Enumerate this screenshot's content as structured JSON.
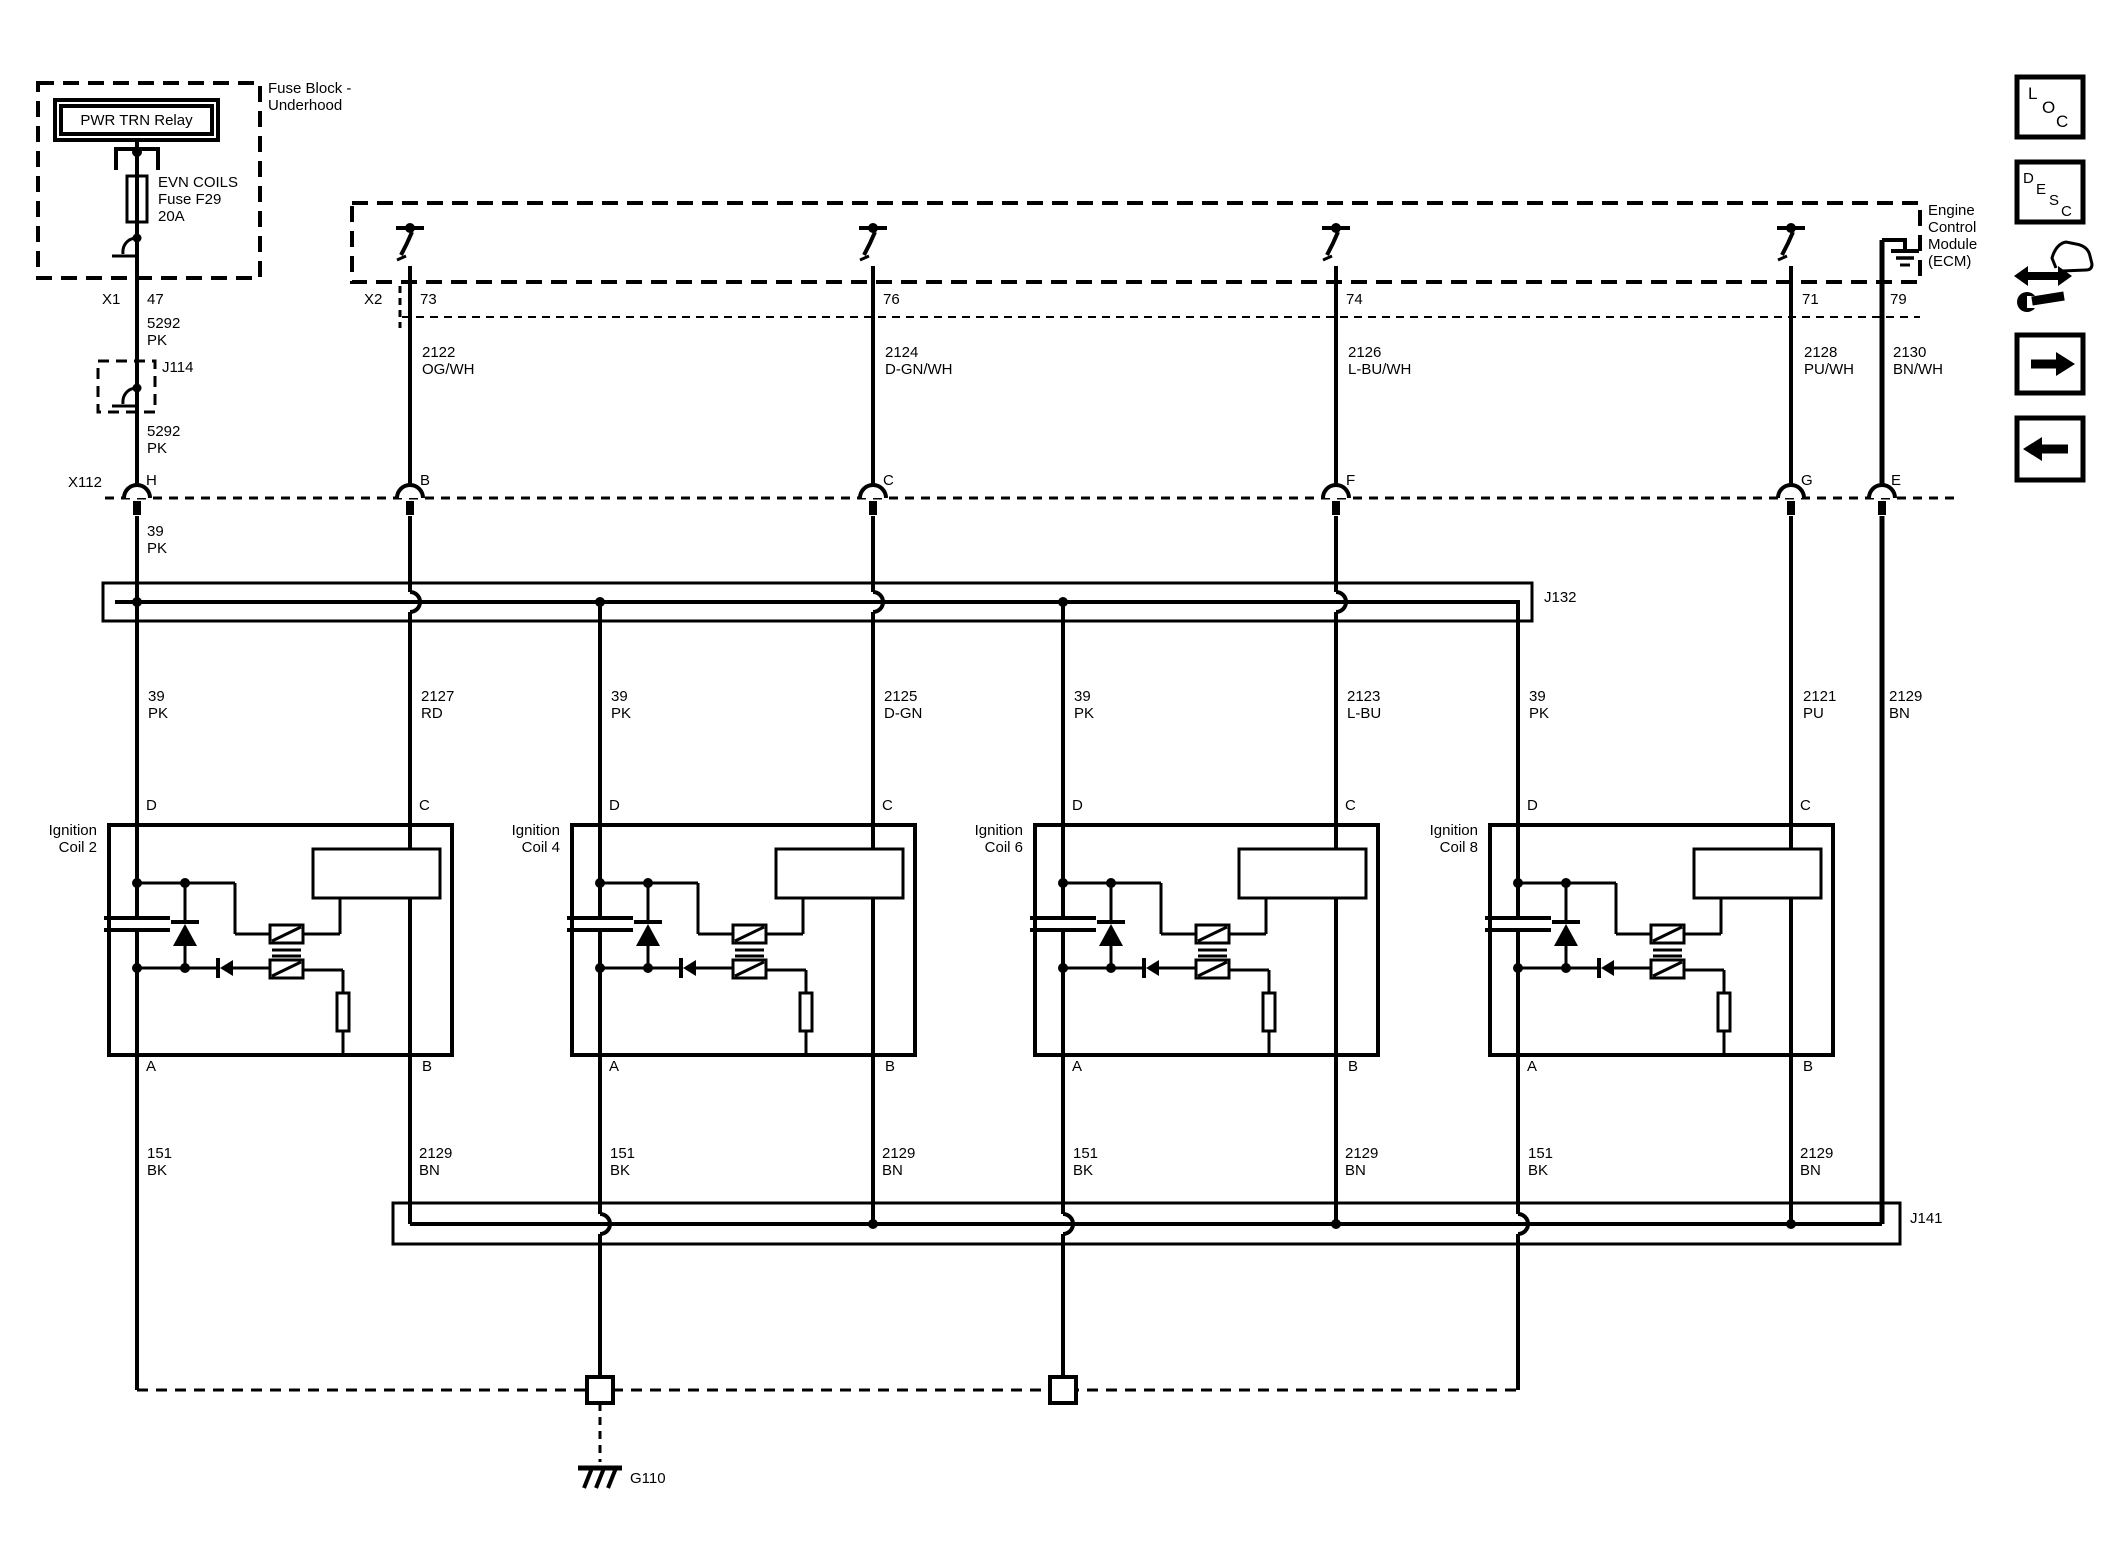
{
  "diagram": {
    "fuse_block": {
      "title1": "Fuse Block -",
      "title2": "Underhood",
      "relay_label": "PWR TRN Relay",
      "fuse_name": "EVN COILS",
      "fuse_id": "Fuse F29",
      "fuse_rating": "20A",
      "connector": "X1",
      "pin": "47"
    },
    "splices": {
      "j114": "J114",
      "j132": "J132",
      "j141": "J141"
    },
    "inline_connector": {
      "label": "X112",
      "terminals": [
        "H",
        "B",
        "C",
        "F",
        "G",
        "E"
      ]
    },
    "ecm": {
      "title1": "Engine",
      "title2": "Control",
      "title3": "Module",
      "title4": "(ECM)",
      "connector": "X2",
      "pins": [
        "73",
        "76",
        "74",
        "71",
        "79"
      ]
    },
    "wires": {
      "feed_a": {
        "circuit": "5292",
        "color": "PK"
      },
      "feed_b": {
        "circuit": "39",
        "color": "PK"
      },
      "ecm_out": [
        {
          "circuit": "2122",
          "color": "OG/WH"
        },
        {
          "circuit": "2124",
          "color": "D-GN/WH"
        },
        {
          "circuit": "2126",
          "color": "L-BU/WH"
        },
        {
          "circuit": "2128",
          "color": "PU/WH"
        },
        {
          "circuit": "2130",
          "color": "BN/WH"
        }
      ],
      "mid": [
        {
          "circuit": "39",
          "color": "PK"
        },
        {
          "circuit": "2127",
          "color": "RD"
        },
        {
          "circuit": "39",
          "color": "PK"
        },
        {
          "circuit": "2125",
          "color": "D-GN"
        },
        {
          "circuit": "39",
          "color": "PK"
        },
        {
          "circuit": "2123",
          "color": "L-BU"
        },
        {
          "circuit": "39",
          "color": "PK"
        },
        {
          "circuit": "2121",
          "color": "PU"
        },
        {
          "circuit": "2129",
          "color": "BN"
        }
      ],
      "coil_ground": {
        "circuit": "151",
        "color": "BK"
      },
      "coil_low_ref": {
        "circuit": "2129",
        "color": "BN"
      }
    },
    "coils": [
      {
        "title1": "Ignition",
        "title2": "Coil 2"
      },
      {
        "title1": "Ignition",
        "title2": "Coil 4"
      },
      {
        "title1": "Ignition",
        "title2": "Coil 6"
      },
      {
        "title1": "Ignition",
        "title2": "Coil 8"
      }
    ],
    "coil_pins": {
      "top_left": "D",
      "top_right": "C",
      "bottom_left": "A",
      "bottom_right": "B"
    },
    "ground": {
      "label": "G110"
    },
    "icons": {
      "loc": [
        "L",
        "O",
        "C"
      ],
      "desc": [
        "D",
        "E",
        "S",
        "C"
      ]
    },
    "colors": {
      "ink": "#000000",
      "paper": "#ffffff"
    }
  }
}
